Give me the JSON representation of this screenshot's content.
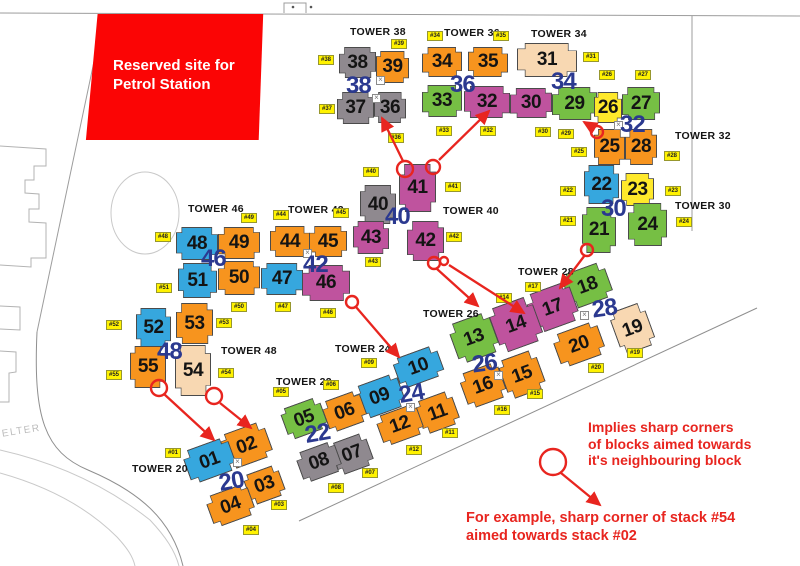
{
  "colors": {
    "orange": "#F7941E",
    "blue": "#36A7DE",
    "green": "#76BF44",
    "magenta": "#BF539E",
    "gray": "#8F898F",
    "tan": "#F8D8B2",
    "yellow": "#FFE92B",
    "tag_yellow": "#FFF200",
    "navy": "#2B3990",
    "red": "#E8251F",
    "petrol_red": "#FB0505"
  },
  "petrol_site": {
    "line1": "Reserved site for",
    "line2": "Petrol Station"
  },
  "shelter_label": "SHELTER",
  "legend": {
    "lines": [
      "Implies sharp corners",
      "of blocks aimed towards",
      "it's neighbouring block"
    ]
  },
  "example": {
    "lines": [
      "For example, sharp corner of stack #54",
      "aimed towards stack #02"
    ]
  },
  "towers": [
    {
      "t": "TOWER 38",
      "x": 350,
      "y": 26
    },
    {
      "t": "TOWER 36",
      "x": 444,
      "y": 27
    },
    {
      "t": "TOWER 34",
      "x": 531,
      "y": 28
    },
    {
      "t": "TOWER 32",
      "x": 675,
      "y": 130
    },
    {
      "t": "TOWER 30",
      "x": 675,
      "y": 200
    },
    {
      "t": "TOWER 28",
      "x": 518,
      "y": 266
    },
    {
      "t": "TOWER 26",
      "x": 423,
      "y": 308
    },
    {
      "t": "TOWER 24",
      "x": 335,
      "y": 343
    },
    {
      "t": "TOWER 22",
      "x": 276,
      "y": 376
    },
    {
      "t": "TOWER 20",
      "x": 132,
      "y": 463
    },
    {
      "t": "TOWER 46",
      "x": 188,
      "y": 203
    },
    {
      "t": "TOWER 42",
      "x": 288,
      "y": 204
    },
    {
      "t": "TOWER 40",
      "x": 443,
      "y": 205
    },
    {
      "t": "TOWER 48",
      "x": 221,
      "y": 345
    }
  ],
  "blocks": [
    {
      "id": "38",
      "c": "gray",
      "x": 339,
      "y": 47,
      "w": 37,
      "h": 31,
      "r": 0
    },
    {
      "id": "39",
      "c": "orange",
      "x": 376,
      "y": 51,
      "w": 33,
      "h": 32,
      "r": 0
    },
    {
      "id": "37",
      "c": "gray",
      "x": 337,
      "y": 92,
      "w": 37,
      "h": 32,
      "r": 0
    },
    {
      "id": "36",
      "c": "gray",
      "x": 374,
      "y": 92,
      "w": 32,
      "h": 31,
      "r": 0
    },
    {
      "id": "34",
      "c": "orange",
      "x": 422,
      "y": 47,
      "w": 40,
      "h": 30,
      "r": 0
    },
    {
      "id": "35",
      "c": "orange",
      "x": 468,
      "y": 47,
      "w": 40,
      "h": 30,
      "r": 0
    },
    {
      "id": "33",
      "c": "green",
      "x": 422,
      "y": 85,
      "w": 40,
      "h": 32,
      "r": 0
    },
    {
      "id": "32",
      "c": "magenta",
      "x": 464,
      "y": 86,
      "w": 46,
      "h": 32,
      "r": 0
    },
    {
      "id": "30",
      "c": "magenta",
      "x": 510,
      "y": 88,
      "w": 42,
      "h": 30,
      "r": 0
    },
    {
      "id": "31",
      "c": "tan",
      "x": 517,
      "y": 43,
      "w": 60,
      "h": 34,
      "r": 0
    },
    {
      "id": "29",
      "c": "green",
      "x": 552,
      "y": 87,
      "w": 45,
      "h": 33,
      "r": 0
    },
    {
      "id": "26",
      "c": "yellow",
      "x": 594,
      "y": 92,
      "w": 28,
      "h": 31,
      "r": 0
    },
    {
      "id": "27",
      "c": "green",
      "x": 622,
      "y": 87,
      "w": 38,
      "h": 33,
      "r": 0
    },
    {
      "id": "25",
      "c": "orange",
      "x": 594,
      "y": 129,
      "w": 31,
      "h": 36,
      "r": 0
    },
    {
      "id": "28",
      "c": "orange",
      "x": 625,
      "y": 129,
      "w": 32,
      "h": 36,
      "r": 0
    },
    {
      "id": "22",
      "c": "blue",
      "x": 584,
      "y": 165,
      "w": 35,
      "h": 39,
      "r": 0
    },
    {
      "id": "23",
      "c": "yellow",
      "x": 621,
      "y": 173,
      "w": 33,
      "h": 33,
      "r": 0
    },
    {
      "id": "21",
      "c": "green",
      "x": 582,
      "y": 207,
      "w": 34,
      "h": 46,
      "r": 0
    },
    {
      "id": "24",
      "c": "green",
      "x": 628,
      "y": 203,
      "w": 39,
      "h": 43,
      "r": 0
    },
    {
      "id": "40",
      "c": "gray",
      "x": 360,
      "y": 185,
      "w": 36,
      "h": 39,
      "r": 0
    },
    {
      "id": "41",
      "c": "magenta",
      "x": 399,
      "y": 164,
      "w": 37,
      "h": 48,
      "r": 0
    },
    {
      "id": "43",
      "c": "magenta",
      "x": 353,
      "y": 221,
      "w": 36,
      "h": 33,
      "r": 0
    },
    {
      "id": "42",
      "c": "magenta",
      "x": 407,
      "y": 221,
      "w": 37,
      "h": 40,
      "r": 0
    },
    {
      "id": "48",
      "c": "blue",
      "x": 176,
      "y": 227,
      "w": 42,
      "h": 33,
      "r": 0
    },
    {
      "id": "49",
      "c": "orange",
      "x": 218,
      "y": 227,
      "w": 42,
      "h": 32,
      "r": 0
    },
    {
      "id": "44",
      "c": "orange",
      "x": 270,
      "y": 226,
      "w": 40,
      "h": 31,
      "r": 0
    },
    {
      "id": "45",
      "c": "orange",
      "x": 309,
      "y": 226,
      "w": 38,
      "h": 31,
      "r": 0
    },
    {
      "id": "51",
      "c": "blue",
      "x": 178,
      "y": 263,
      "w": 39,
      "h": 35,
      "r": 0
    },
    {
      "id": "50",
      "c": "orange",
      "x": 218,
      "y": 261,
      "w": 42,
      "h": 34,
      "r": 0
    },
    {
      "id": "47",
      "c": "blue",
      "x": 261,
      "y": 263,
      "w": 42,
      "h": 32,
      "r": 0
    },
    {
      "id": "46",
      "c": "magenta",
      "x": 302,
      "y": 265,
      "w": 48,
      "h": 36,
      "r": 0
    },
    {
      "id": "52",
      "c": "blue",
      "x": 136,
      "y": 308,
      "w": 35,
      "h": 39,
      "r": 0
    },
    {
      "id": "53",
      "c": "orange",
      "x": 176,
      "y": 303,
      "w": 37,
      "h": 41,
      "r": 0
    },
    {
      "id": "55",
      "c": "orange",
      "x": 130,
      "y": 346,
      "w": 36,
      "h": 42,
      "r": 0
    },
    {
      "id": "54",
      "c": "tan",
      "x": 175,
      "y": 345,
      "w": 36,
      "h": 51,
      "r": 0
    },
    {
      "id": "18",
      "c": "green",
      "x": 565,
      "y": 267,
      "w": 45,
      "h": 37,
      "r": -20
    },
    {
      "id": "17",
      "c": "magenta",
      "x": 529,
      "y": 287,
      "w": 47,
      "h": 41,
      "r": -20
    },
    {
      "id": "14",
      "c": "magenta",
      "x": 493,
      "y": 301,
      "w": 46,
      "h": 47,
      "r": -20
    },
    {
      "id": "13",
      "c": "green",
      "x": 452,
      "y": 317,
      "w": 44,
      "h": 42,
      "r": -20
    },
    {
      "id": "19",
      "c": "tan",
      "x": 614,
      "y": 306,
      "w": 37,
      "h": 45,
      "r": -20
    },
    {
      "id": "20",
      "c": "orange",
      "x": 555,
      "y": 327,
      "w": 48,
      "h": 35,
      "r": -20
    },
    {
      "id": "15",
      "c": "orange",
      "x": 502,
      "y": 354,
      "w": 40,
      "h": 41,
      "r": -20
    },
    {
      "id": "16",
      "c": "orange",
      "x": 462,
      "y": 367,
      "w": 42,
      "h": 37,
      "r": -20
    },
    {
      "id": "10",
      "c": "blue",
      "x": 395,
      "y": 351,
      "w": 47,
      "h": 32,
      "r": -20
    },
    {
      "id": "09",
      "c": "blue",
      "x": 356,
      "y": 379,
      "w": 47,
      "h": 35,
      "r": -20
    },
    {
      "id": "11",
      "c": "orange",
      "x": 418,
      "y": 395,
      "w": 39,
      "h": 35,
      "r": -20
    },
    {
      "id": "12",
      "c": "orange",
      "x": 378,
      "y": 409,
      "w": 44,
      "h": 32,
      "r": -20
    },
    {
      "id": "05",
      "c": "green",
      "x": 283,
      "y": 402,
      "w": 42,
      "h": 33,
      "r": -20
    },
    {
      "id": "06",
      "c": "orange",
      "x": 324,
      "y": 395,
      "w": 41,
      "h": 33,
      "r": -20
    },
    {
      "id": "07",
      "c": "gray",
      "x": 333,
      "y": 437,
      "w": 38,
      "h": 34,
      "r": -20
    },
    {
      "id": "08",
      "c": "gray",
      "x": 298,
      "y": 446,
      "w": 42,
      "h": 32,
      "r": -20
    },
    {
      "id": "02",
      "c": "orange",
      "x": 223,
      "y": 427,
      "w": 47,
      "h": 37,
      "r": -20
    },
    {
      "id": "01",
      "c": "blue",
      "x": 185,
      "y": 443,
      "w": 49,
      "h": 35,
      "r": -20
    },
    {
      "id": "03",
      "c": "orange",
      "x": 246,
      "y": 469,
      "w": 37,
      "h": 32,
      "r": -20
    },
    {
      "id": "04",
      "c": "orange",
      "x": 208,
      "y": 489,
      "w": 45,
      "h": 33,
      "r": -20
    }
  ],
  "stack_tags": [
    {
      "t": "#38",
      "x": 318,
      "y": 55
    },
    {
      "t": "#39",
      "x": 391,
      "y": 39
    },
    {
      "t": "#37",
      "x": 319,
      "y": 104
    },
    {
      "t": "#36",
      "x": 388,
      "y": 133
    },
    {
      "t": "#34",
      "x": 427,
      "y": 31
    },
    {
      "t": "#35",
      "x": 493,
      "y": 31
    },
    {
      "t": "#33",
      "x": 436,
      "y": 126
    },
    {
      "t": "#32",
      "x": 480,
      "y": 126
    },
    {
      "t": "#30",
      "x": 535,
      "y": 127
    },
    {
      "t": "#31",
      "x": 583,
      "y": 52
    },
    {
      "t": "#29",
      "x": 558,
      "y": 129
    },
    {
      "t": "#26",
      "x": 599,
      "y": 70
    },
    {
      "t": "#27",
      "x": 635,
      "y": 70
    },
    {
      "t": "#25",
      "x": 571,
      "y": 147
    },
    {
      "t": "#28",
      "x": 664,
      "y": 151
    },
    {
      "t": "#22",
      "x": 560,
      "y": 186
    },
    {
      "t": "#23",
      "x": 665,
      "y": 186
    },
    {
      "t": "#21",
      "x": 560,
      "y": 216
    },
    {
      "t": "#24",
      "x": 676,
      "y": 217
    },
    {
      "t": "#40",
      "x": 363,
      "y": 167
    },
    {
      "t": "#41",
      "x": 445,
      "y": 182
    },
    {
      "t": "#42",
      "x": 446,
      "y": 232
    },
    {
      "t": "#43",
      "x": 365,
      "y": 257
    },
    {
      "t": "#48",
      "x": 155,
      "y": 232
    },
    {
      "t": "#49",
      "x": 241,
      "y": 213
    },
    {
      "t": "#44",
      "x": 273,
      "y": 210
    },
    {
      "t": "#45",
      "x": 333,
      "y": 208
    },
    {
      "t": "#51",
      "x": 156,
      "y": 283
    },
    {
      "t": "#50",
      "x": 231,
      "y": 302
    },
    {
      "t": "#47",
      "x": 275,
      "y": 302
    },
    {
      "t": "#46",
      "x": 320,
      "y": 308
    },
    {
      "t": "#52",
      "x": 106,
      "y": 320
    },
    {
      "t": "#53",
      "x": 216,
      "y": 318
    },
    {
      "t": "#55",
      "x": 106,
      "y": 370
    },
    {
      "t": "#54",
      "x": 218,
      "y": 368
    },
    {
      "t": "#17",
      "x": 525,
      "y": 282
    },
    {
      "t": "#14",
      "x": 496,
      "y": 293
    },
    {
      "t": "#19",
      "x": 627,
      "y": 348
    },
    {
      "t": "#20",
      "x": 588,
      "y": 363
    },
    {
      "t": "#15",
      "x": 527,
      "y": 389
    },
    {
      "t": "#16",
      "x": 494,
      "y": 405
    },
    {
      "t": "#09",
      "x": 361,
      "y": 358
    },
    {
      "t": "#06",
      "x": 323,
      "y": 380
    },
    {
      "t": "#05",
      "x": 273,
      "y": 387
    },
    {
      "t": "#11",
      "x": 442,
      "y": 428
    },
    {
      "t": "#12",
      "x": 406,
      "y": 445
    },
    {
      "t": "#07",
      "x": 362,
      "y": 468
    },
    {
      "t": "#08",
      "x": 328,
      "y": 483
    },
    {
      "t": "#01",
      "x": 165,
      "y": 448
    },
    {
      "t": "#03",
      "x": 271,
      "y": 500
    },
    {
      "t": "#04",
      "x": 243,
      "y": 525
    }
  ],
  "group_labels": [
    {
      "t": "38",
      "x": 346,
      "y": 74,
      "r": 0
    },
    {
      "t": "36",
      "x": 450,
      "y": 73,
      "r": 0
    },
    {
      "t": "34",
      "x": 551,
      "y": 70,
      "r": 0
    },
    {
      "t": "32",
      "x": 620,
      "y": 113,
      "r": 0
    },
    {
      "t": "30",
      "x": 601,
      "y": 197,
      "r": 0
    },
    {
      "t": "40",
      "x": 385,
      "y": 205,
      "r": 0
    },
    {
      "t": "42",
      "x": 303,
      "y": 253,
      "r": 0
    },
    {
      "t": "46",
      "x": 201,
      "y": 247,
      "r": 0
    },
    {
      "t": "48",
      "x": 157,
      "y": 340,
      "r": 0
    },
    {
      "t": "28",
      "x": 592,
      "y": 297,
      "r": -8
    },
    {
      "t": "26",
      "x": 472,
      "y": 352,
      "r": -8
    },
    {
      "t": "24",
      "x": 399,
      "y": 382,
      "r": -10
    },
    {
      "t": "22",
      "x": 305,
      "y": 422,
      "r": -10
    },
    {
      "t": "20",
      "x": 219,
      "y": 470,
      "r": -10
    }
  ],
  "sharp_corner_circles": [
    {
      "cx": 405,
      "cy": 169,
      "r": 8
    },
    {
      "cx": 433,
      "cy": 167,
      "r": 7
    },
    {
      "cx": 597,
      "cy": 132,
      "r": 6
    },
    {
      "cx": 587,
      "cy": 250,
      "r": 6
    },
    {
      "cx": 352,
      "cy": 302,
      "r": 6
    },
    {
      "cx": 434,
      "cy": 263,
      "r": 6
    },
    {
      "cx": 444,
      "cy": 261,
      "r": 4
    },
    {
      "cx": 159,
      "cy": 388,
      "r": 8
    },
    {
      "cx": 214,
      "cy": 396,
      "r": 8
    },
    {
      "cx": 553,
      "cy": 462,
      "r": 13
    }
  ],
  "arrows": [
    {
      "x1": 403,
      "y1": 161,
      "x2": 382,
      "y2": 118
    },
    {
      "x1": 439,
      "y1": 160,
      "x2": 489,
      "y2": 111
    },
    {
      "x1": 594,
      "y1": 128,
      "x2": 584,
      "y2": 122
    },
    {
      "x1": 585,
      "y1": 255,
      "x2": 560,
      "y2": 288
    },
    {
      "x1": 356,
      "y1": 307,
      "x2": 399,
      "y2": 357
    },
    {
      "x1": 437,
      "y1": 269,
      "x2": 478,
      "y2": 306
    },
    {
      "x1": 449,
      "y1": 265,
      "x2": 524,
      "y2": 313
    },
    {
      "x1": 164,
      "y1": 394,
      "x2": 214,
      "y2": 440
    },
    {
      "x1": 220,
      "y1": 403,
      "x2": 251,
      "y2": 428
    },
    {
      "x1": 561,
      "y1": 473,
      "x2": 600,
      "y2": 505
    }
  ],
  "stair_icons": [
    {
      "x": 376,
      "y": 76
    },
    {
      "x": 372,
      "y": 94
    },
    {
      "x": 303,
      "y": 249
    },
    {
      "x": 614,
      "y": 121
    },
    {
      "x": 580,
      "y": 311
    },
    {
      "x": 494,
      "y": 371
    },
    {
      "x": 406,
      "y": 403
    },
    {
      "x": 233,
      "y": 458
    }
  ]
}
